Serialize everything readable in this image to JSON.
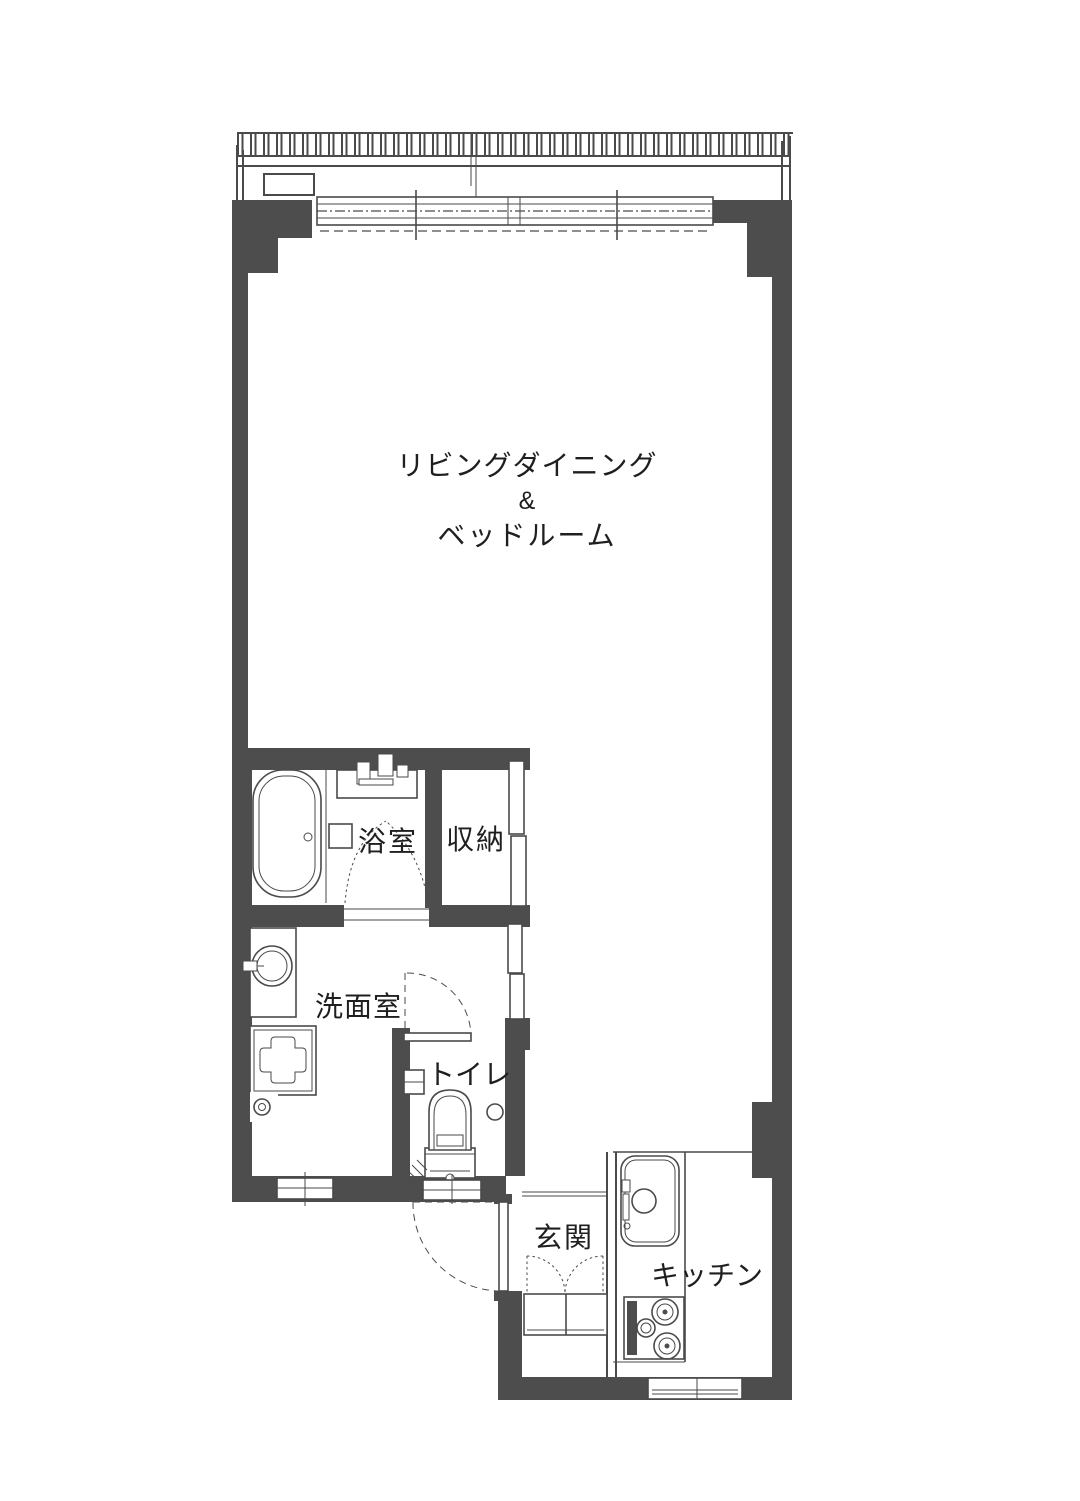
{
  "colors": {
    "wall": "#4d4d4d",
    "line": "#4a4a4a",
    "text": "#1f1f1f",
    "bg": "#ffffff"
  },
  "rooms": {
    "living": {
      "line1": "リビングダイニング",
      "line2": "&",
      "line3": "ベッドルーム"
    },
    "bath": {
      "label": "浴室"
    },
    "storage": {
      "label": "収納"
    },
    "washroom": {
      "label": "洗面室"
    },
    "toilet": {
      "label": "トイレ"
    },
    "entrance": {
      "label": "玄関"
    },
    "kitchen": {
      "label": "キッチン"
    }
  }
}
